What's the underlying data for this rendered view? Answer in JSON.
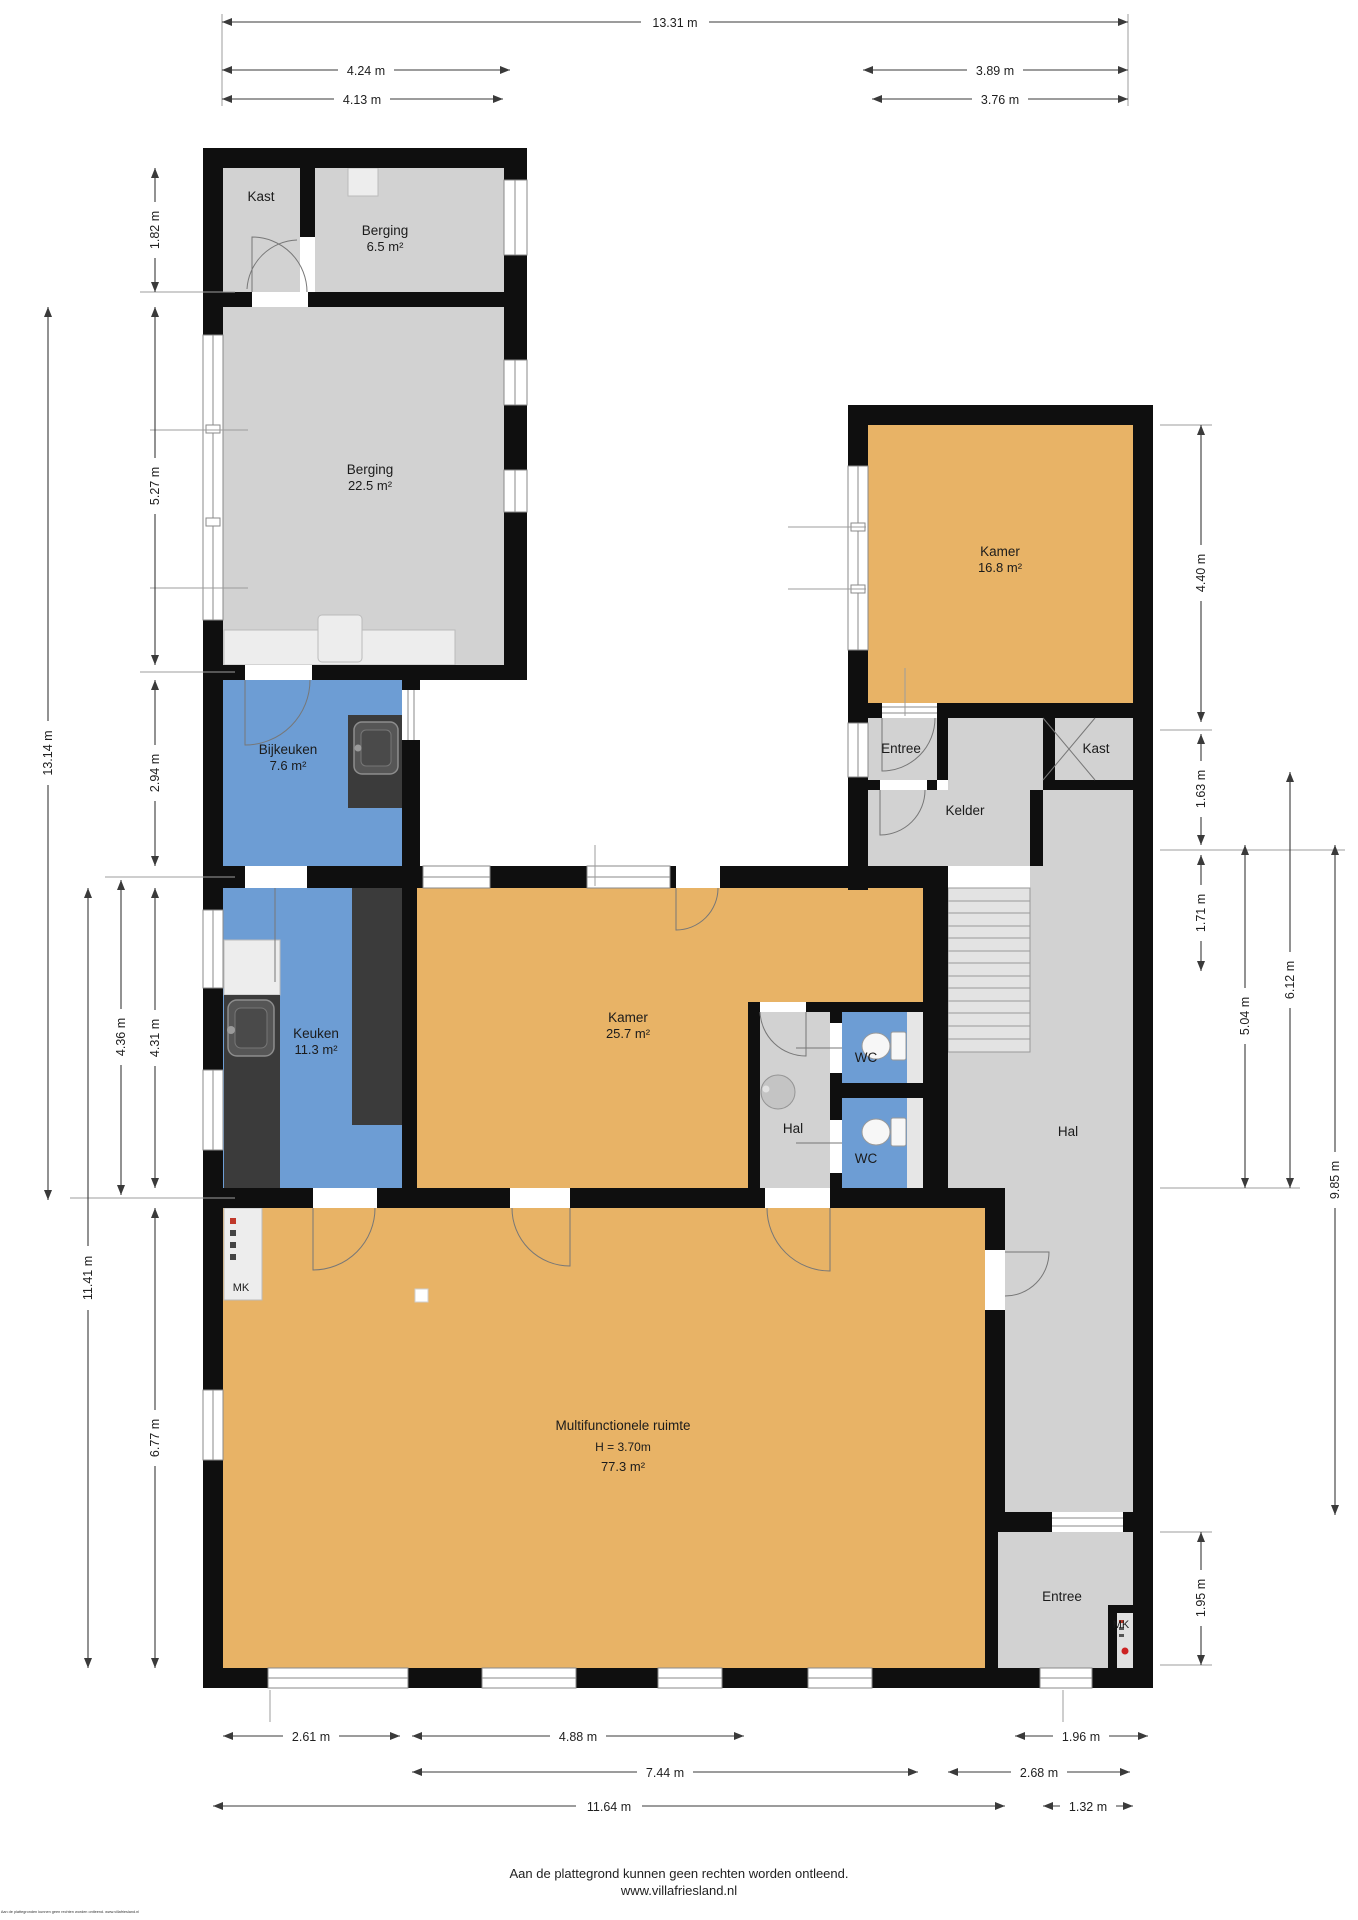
{
  "colors": {
    "wall": "#0f0f0f",
    "room_gray": "#d2d2d2",
    "room_orange": "#e8b366",
    "room_blue": "#6d9dd4",
    "fixture_dark": "#3b3b3b",
    "stairs": "#e3e3e3",
    "accent_red": "#cc2222"
  },
  "rooms": {
    "kast_top": {
      "name": "Kast"
    },
    "berging_small": {
      "name": "Berging",
      "area": "6.5 m²"
    },
    "berging_large": {
      "name": "Berging",
      "area": "22.5 m²"
    },
    "bijkeuken": {
      "name": "Bijkeuken",
      "area": "7.6 m²"
    },
    "keuken": {
      "name": "Keuken",
      "area": "11.3 m²"
    },
    "kamer_groot": {
      "name": "Kamer",
      "area": "25.7 m²"
    },
    "kamer_klein": {
      "name": "Kamer",
      "area": "16.8 m²"
    },
    "entree_boven": {
      "name": "Entree"
    },
    "kast_rechts": {
      "name": "Kast"
    },
    "kelder": {
      "name": "Kelder"
    },
    "wc_1": {
      "name": "WC"
    },
    "wc_2": {
      "name": "WC"
    },
    "hal_midden": {
      "name": "Hal"
    },
    "hal_rechts": {
      "name": "Hal"
    },
    "multifunctioneel": {
      "name": "Multifunctionele ruimte",
      "height": "H = 3.70m",
      "area": "77.3 m²"
    },
    "entree_onder": {
      "name": "Entree"
    },
    "mk_links": {
      "name": "MK"
    },
    "mk_rechts": {
      "name": "MK"
    }
  },
  "dimensions": {
    "top": [
      "13.31 m",
      "4.24 m",
      "3.89 m",
      "4.13 m",
      "3.76 m"
    ],
    "left": [
      "1.82 m",
      "5.27 m",
      "13.14 m",
      "2.94 m",
      "4.36 m",
      "4.31 m",
      "11.41 m",
      "6.77 m"
    ],
    "right": [
      "4.40 m",
      "1.63 m",
      "1.71 m",
      "5.04 m",
      "6.12 m",
      "9.85 m",
      "1.95 m"
    ],
    "bottom": [
      "2.61 m",
      "4.88 m",
      "1.96 m",
      "7.44 m",
      "2.68 m",
      "11.64 m",
      "1.32 m"
    ]
  },
  "footer": {
    "disclaimer": "Aan de plattegrond kunnen geen rechten worden ontleend.",
    "website": "www.villafriesland.nl",
    "fine_print": "Aan de plattegronden kunnen geen rechten worden ontleend. www.villafriesland.nl"
  }
}
